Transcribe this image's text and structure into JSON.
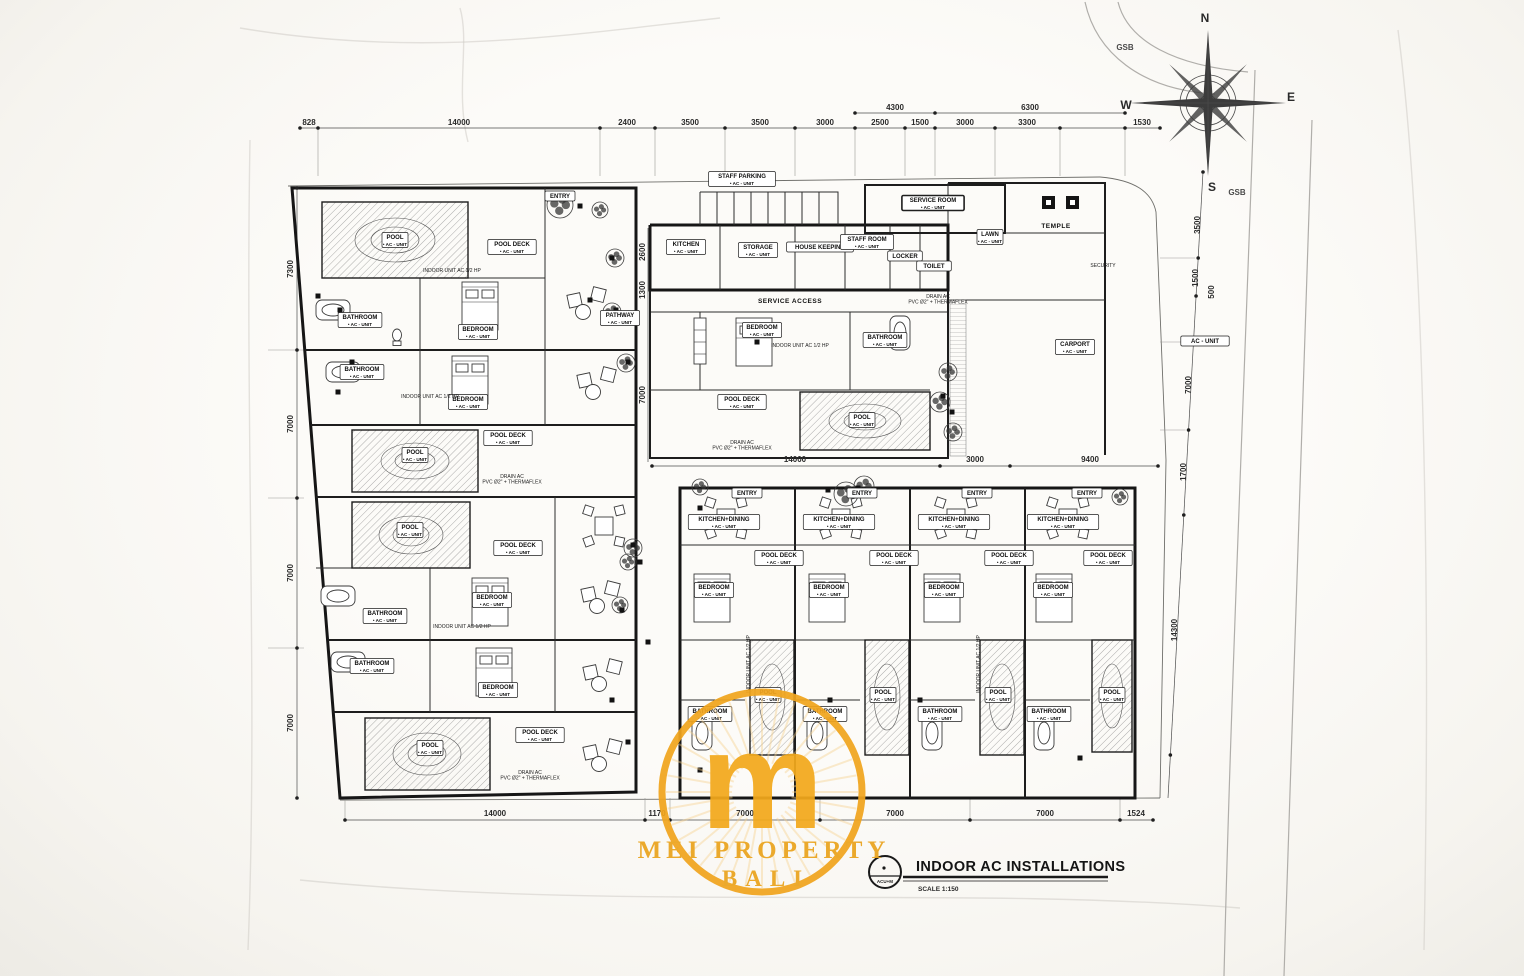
{
  "title_block": {
    "title": "INDOOR AC INSTALLATIONS",
    "scale": "SCALE 1:150",
    "bubble": "ACU+M"
  },
  "compass": {
    "n": "N",
    "e": "E",
    "w": "W",
    "s": "S",
    "gsb_top": "GSB",
    "gsb_bottom": "GSB"
  },
  "watermark": {
    "monogram": "m",
    "name": "MEI PROPERTY",
    "place": "BALI"
  },
  "labels": {
    "ac_unit": "AC - UNIT",
    "indoor_unit": "INDOOR UNIT AC 1/2 HP",
    "drain_1": "DRAIN AC",
    "drain_2": "PVC Ø2\" + THERMAFLEX",
    "service_access": "SERVICE ACCESS",
    "temple": "TEMPLE",
    "security": "SECURITY"
  },
  "dimensions": [
    {
      "x": 309,
      "y": 125,
      "v": "828"
    },
    {
      "x": 459,
      "y": 125,
      "v": "14000"
    },
    {
      "x": 627,
      "y": 125,
      "v": "2400"
    },
    {
      "x": 690,
      "y": 125,
      "v": "3500"
    },
    {
      "x": 760,
      "y": 125,
      "v": "3500"
    },
    {
      "x": 825,
      "y": 125,
      "v": "3000"
    },
    {
      "x": 880,
      "y": 125,
      "v": "2500"
    },
    {
      "x": 920,
      "y": 125,
      "v": "1500"
    },
    {
      "x": 965,
      "y": 125,
      "v": "3000"
    },
    {
      "x": 1027,
      "y": 125,
      "v": "3300"
    },
    {
      "x": 1142,
      "y": 125,
      "v": "1530"
    },
    {
      "x": 895,
      "y": 110,
      "v": "4300"
    },
    {
      "x": 1030,
      "y": 110,
      "v": "6300"
    },
    {
      "x": 293,
      "y": 269,
      "v": "7300",
      "rot": 1
    },
    {
      "x": 293,
      "y": 424,
      "v": "7000",
      "rot": 1
    },
    {
      "x": 293,
      "y": 573,
      "v": "7000",
      "rot": 1
    },
    {
      "x": 293,
      "y": 723,
      "v": "7000",
      "rot": 1
    },
    {
      "x": 1200,
      "y": 225,
      "v": "3500",
      "rot": 1
    },
    {
      "x": 1198,
      "y": 278,
      "v": "1500",
      "rot": 1
    },
    {
      "x": 1214,
      "y": 292,
      "v": "500",
      "rot": 1
    },
    {
      "x": 1191,
      "y": 385,
      "v": "7000",
      "rot": 1
    },
    {
      "x": 1186,
      "y": 472,
      "v": "1700",
      "rot": 1
    },
    {
      "x": 1177,
      "y": 630,
      "v": "14300",
      "rot": 1
    },
    {
      "x": 495,
      "y": 816,
      "v": "14000"
    },
    {
      "x": 657,
      "y": 816,
      "v": "1170"
    },
    {
      "x": 745,
      "y": 816,
      "v": "7000"
    },
    {
      "x": 895,
      "y": 816,
      "v": "7000"
    },
    {
      "x": 1045,
      "y": 816,
      "v": "7000"
    },
    {
      "x": 1136,
      "y": 816,
      "v": "1524"
    },
    {
      "x": 795,
      "y": 462,
      "v": "14000"
    },
    {
      "x": 975,
      "y": 462,
      "v": "3000"
    },
    {
      "x": 1090,
      "y": 462,
      "v": "9400"
    },
    {
      "x": 645,
      "y": 252,
      "v": "2600",
      "rot": 1
    },
    {
      "x": 645,
      "y": 290,
      "v": "1300",
      "rot": 1
    },
    {
      "x": 645,
      "y": 395,
      "v": "7000",
      "rot": 1
    }
  ],
  "room_tags": [
    {
      "x": 395,
      "y": 240,
      "t": "POOL",
      "ac": true
    },
    {
      "x": 512,
      "y": 247,
      "t": "POOL DECK",
      "ac": true
    },
    {
      "x": 478,
      "y": 332,
      "t": "BEDROOM",
      "ac": true
    },
    {
      "x": 360,
      "y": 320,
      "t": "BATHROOM",
      "ac": true
    },
    {
      "x": 362,
      "y": 372,
      "t": "BATHROOM",
      "ac": true
    },
    {
      "x": 468,
      "y": 402,
      "t": "BEDROOM",
      "ac": true
    },
    {
      "x": 415,
      "y": 455,
      "t": "POOL",
      "ac": true
    },
    {
      "x": 508,
      "y": 438,
      "t": "POOL DECK",
      "ac": true
    },
    {
      "x": 410,
      "y": 530,
      "t": "POOL",
      "ac": true
    },
    {
      "x": 518,
      "y": 548,
      "t": "POOL DECK",
      "ac": true
    },
    {
      "x": 385,
      "y": 616,
      "t": "BATHROOM",
      "ac": true
    },
    {
      "x": 492,
      "y": 600,
      "t": "BEDROOM",
      "ac": true
    },
    {
      "x": 372,
      "y": 666,
      "t": "BATHROOM",
      "ac": true
    },
    {
      "x": 498,
      "y": 690,
      "t": "BEDROOM",
      "ac": true
    },
    {
      "x": 430,
      "y": 748,
      "t": "POOL",
      "ac": true
    },
    {
      "x": 540,
      "y": 735,
      "t": "POOL DECK",
      "ac": true
    },
    {
      "x": 742,
      "y": 179,
      "t": "STAFF PARKING",
      "ac": true
    },
    {
      "x": 933,
      "y": 203,
      "t": "SERVICE ROOM",
      "ac": true,
      "bold": true
    },
    {
      "x": 686,
      "y": 247,
      "t": "KITCHEN",
      "ac": true
    },
    {
      "x": 758,
      "y": 250,
      "t": "STORAGE",
      "ac": true
    },
    {
      "x": 820,
      "y": 247,
      "t": "HOUSE KEEPING",
      "ac": false
    },
    {
      "x": 867,
      "y": 242,
      "t": "STAFF ROOM",
      "ac": true
    },
    {
      "x": 905,
      "y": 256,
      "t": "LOCKER",
      "ac": false
    },
    {
      "x": 934,
      "y": 266,
      "t": "TOILET",
      "ac": false
    },
    {
      "x": 990,
      "y": 237,
      "t": "LAWN",
      "ac": true
    },
    {
      "x": 762,
      "y": 330,
      "t": "BEDROOM",
      "ac": true
    },
    {
      "x": 885,
      "y": 340,
      "t": "BATHROOM",
      "ac": true
    },
    {
      "x": 742,
      "y": 402,
      "t": "POOL DECK",
      "ac": true
    },
    {
      "x": 862,
      "y": 420,
      "t": "POOL",
      "ac": true
    },
    {
      "x": 1075,
      "y": 347,
      "t": "CARPORT",
      "ac": true
    },
    {
      "x": 620,
      "y": 318,
      "t": "PATHWAY",
      "ac": true
    },
    {
      "x": 1205,
      "y": 341,
      "t": "AC - UNIT",
      "ac": false
    },
    {
      "x": 560,
      "y": 196,
      "t": "ENTRY",
      "ac": false
    },
    {
      "x": 747,
      "y": 493,
      "t": "ENTRY",
      "ac": false
    },
    {
      "x": 862,
      "y": 493,
      "t": "ENTRY",
      "ac": false
    },
    {
      "x": 977,
      "y": 493,
      "t": "ENTRY",
      "ac": false
    },
    {
      "x": 1087,
      "y": 493,
      "t": "ENTRY",
      "ac": false
    },
    {
      "x": 724,
      "y": 522,
      "t": "KITCHEN+DINING",
      "ac": true
    },
    {
      "x": 779,
      "y": 558,
      "t": "POOL DECK",
      "ac": true
    },
    {
      "x": 714,
      "y": 590,
      "t": "BEDROOM",
      "ac": true
    },
    {
      "x": 768,
      "y": 695,
      "t": "POOL",
      "ac": true
    },
    {
      "x": 710,
      "y": 714,
      "t": "BATHROOM",
      "ac": true
    },
    {
      "x": 839,
      "y": 522,
      "t": "KITCHEN+DINING",
      "ac": true
    },
    {
      "x": 894,
      "y": 558,
      "t": "POOL DECK",
      "ac": true
    },
    {
      "x": 829,
      "y": 590,
      "t": "BEDROOM",
      "ac": true
    },
    {
      "x": 883,
      "y": 695,
      "t": "POOL",
      "ac": true
    },
    {
      "x": 825,
      "y": 714,
      "t": "BATHROOM",
      "ac": true
    },
    {
      "x": 954,
      "y": 522,
      "t": "KITCHEN+DINING",
      "ac": true
    },
    {
      "x": 1009,
      "y": 558,
      "t": "POOL DECK",
      "ac": true
    },
    {
      "x": 944,
      "y": 590,
      "t": "BEDROOM",
      "ac": true
    },
    {
      "x": 998,
      "y": 695,
      "t": "POOL",
      "ac": true
    },
    {
      "x": 940,
      "y": 714,
      "t": "BATHROOM",
      "ac": true
    },
    {
      "x": 1063,
      "y": 522,
      "t": "KITCHEN+DINING",
      "ac": true
    },
    {
      "x": 1108,
      "y": 558,
      "t": "POOL DECK",
      "ac": true
    },
    {
      "x": 1053,
      "y": 590,
      "t": "BEDROOM",
      "ac": true
    },
    {
      "x": 1112,
      "y": 695,
      "t": "POOL",
      "ac": true
    },
    {
      "x": 1049,
      "y": 714,
      "t": "BATHROOM",
      "ac": true
    }
  ],
  "notes": [
    {
      "x": 790,
      "y": 303,
      "t": "SERVICE ACCESS",
      "b": 1
    },
    {
      "x": 1056,
      "y": 228,
      "t": "TEMPLE",
      "b": 1
    },
    {
      "x": 1103,
      "y": 267,
      "t": "SECURITY"
    },
    {
      "x": 452,
      "y": 272,
      "t": "INDOOR UNIT AC 1/2 HP"
    },
    {
      "x": 430,
      "y": 398,
      "t": "INDOOR UNIT AC 1/2 HP"
    },
    {
      "x": 800,
      "y": 347,
      "t": "INDOOR UNIT AC 1/2 HP"
    },
    {
      "x": 462,
      "y": 628,
      "t": "INDOOR UNIT AC 1/2 HP"
    },
    {
      "x": 750,
      "y": 664,
      "t": "INDOOR UNIT AC 1/2 HP",
      "rot": 1
    },
    {
      "x": 980,
      "y": 664,
      "t": "INDOOR UNIT AC 1/2 HP",
      "rot": 1
    },
    {
      "x": 512,
      "y": 478,
      "t": "DRAIN AC",
      "t2": "PVC Ø2\" + THERMAFLEX"
    },
    {
      "x": 742,
      "y": 444,
      "t": "DRAIN AC",
      "t2": "PVC Ø2\" + THERMAFLEX"
    },
    {
      "x": 530,
      "y": 774,
      "t": "DRAIN AC",
      "t2": "PVC Ø2\" + THERMAFLEX"
    },
    {
      "x": 938,
      "y": 298,
      "t": "DRAIN AC",
      "t2": "PVC Ø2\" + THERMAFLEX"
    }
  ],
  "ac_points": [
    [
      318,
      296
    ],
    [
      340,
      310
    ],
    [
      352,
      362
    ],
    [
      338,
      392
    ],
    [
      580,
      206
    ],
    [
      590,
      300
    ],
    [
      612,
      258
    ],
    [
      616,
      310
    ],
    [
      628,
      362
    ],
    [
      633,
      545
    ],
    [
      640,
      562
    ],
    [
      622,
      610
    ],
    [
      648,
      642
    ],
    [
      700,
      508
    ],
    [
      828,
      490
    ],
    [
      858,
      488
    ],
    [
      943,
      396
    ],
    [
      952,
      412
    ],
    [
      700,
      770
    ],
    [
      830,
      700
    ],
    [
      920,
      700
    ],
    [
      1000,
      698
    ],
    [
      1080,
      758
    ],
    [
      878,
      344
    ],
    [
      757,
      342
    ],
    [
      612,
      700
    ],
    [
      628,
      742
    ]
  ],
  "plants": [
    [
      560,
      205,
      13
    ],
    [
      600,
      210,
      8
    ],
    [
      615,
      258,
      9
    ],
    [
      612,
      312,
      9
    ],
    [
      626,
      363,
      9
    ],
    [
      633,
      548,
      9
    ],
    [
      628,
      562,
      8
    ],
    [
      620,
      605,
      8
    ],
    [
      846,
      494,
      12
    ],
    [
      864,
      486,
      10
    ],
    [
      940,
      402,
      10
    ],
    [
      953,
      432,
      9
    ],
    [
      948,
      372,
      9
    ],
    [
      700,
      487,
      8
    ],
    [
      1120,
      497,
      8
    ]
  ]
}
